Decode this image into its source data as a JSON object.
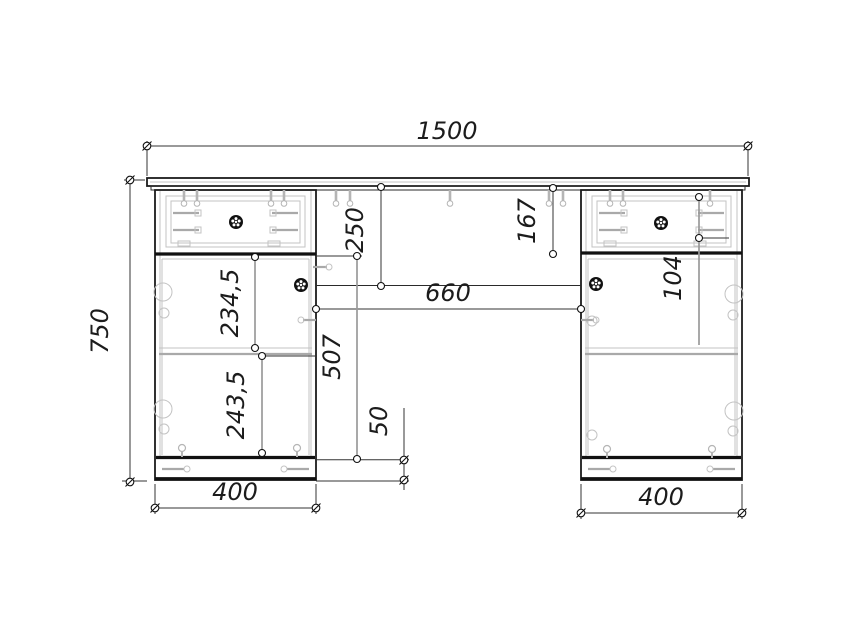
{
  "diagram": {
    "type": "furniture-assembly-drawing",
    "subject": "double pedestal desk, front elevation",
    "units": "mm",
    "style": {
      "outline_color": "#1b1b1b",
      "hardware_color": "#b5b5b5",
      "dimension_color": "#333333",
      "background": "#ffffff"
    },
    "dims": {
      "total_width": "1500",
      "total_height": "750",
      "back_panel_height": "250",
      "right_drawer_section_height": "167",
      "knee_space_width": "660",
      "right_drawer_front_height": "104",
      "left_door_upper_section": "234,5",
      "left_door_lower_section": "243,5",
      "left_door_total_height": "507",
      "plinth_height": "50",
      "left_pedestal_width": "400",
      "right_pedestal_width": "400"
    }
  }
}
